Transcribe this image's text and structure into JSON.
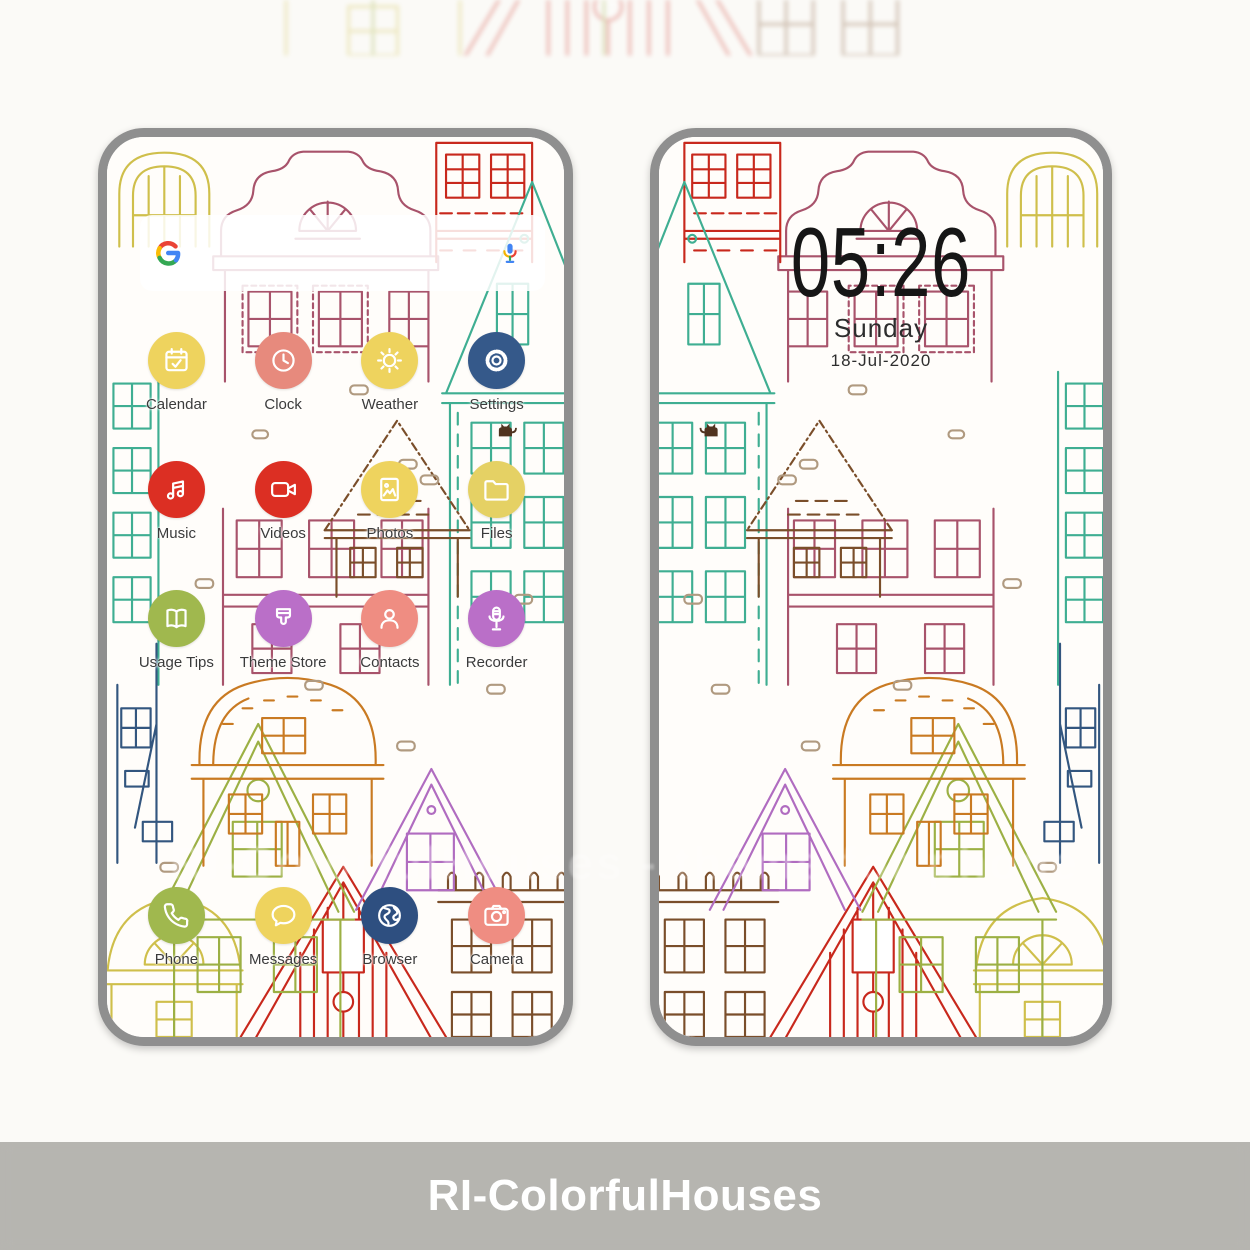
{
  "banner": {
    "title": "RI-ColorfulHouses"
  },
  "watermark": {
    "text": "RI-ColorfulHouses - theme for phone"
  },
  "left_phone": {
    "screen": "home",
    "search_widget": {
      "logo_icon": "google-g-icon",
      "mic_icon": "google-mic-icon"
    },
    "app_rows": [
      [
        {
          "label": "Calendar",
          "icon": "calendar-icon",
          "color": "#eed35e"
        },
        {
          "label": "Clock",
          "icon": "clock-icon",
          "color": "#e78a7d"
        },
        {
          "label": "Weather",
          "icon": "weather-icon",
          "color": "#eed35e"
        },
        {
          "label": "Settings",
          "icon": "settings-icon",
          "color": "#35598a"
        }
      ],
      [
        {
          "label": "Music",
          "icon": "music-icon",
          "color": "#dc2f23"
        },
        {
          "label": "Videos",
          "icon": "videos-icon",
          "color": "#dc2f23"
        },
        {
          "label": "Photos",
          "icon": "photos-icon",
          "color": "#eed35e"
        },
        {
          "label": "Files",
          "icon": "files-icon",
          "color": "#e5d164"
        }
      ],
      [
        {
          "label": "Usage Tips",
          "icon": "usage-tips-icon",
          "color": "#a0b84e"
        },
        {
          "label": "Theme Store",
          "icon": "theme-store-icon",
          "color": "#ba6fc8"
        },
        {
          "label": "Contacts",
          "icon": "contacts-icon",
          "color": "#ef8d82"
        },
        {
          "label": "Recorder",
          "icon": "recorder-icon",
          "color": "#ba6fc8"
        }
      ]
    ],
    "dock": [
      {
        "label": "Phone",
        "icon": "phone-icon",
        "color": "#a0b84e"
      },
      {
        "label": "Messages",
        "icon": "messages-icon",
        "color": "#eed35e"
      },
      {
        "label": "Browser",
        "icon": "browser-icon",
        "color": "#2e4f80"
      },
      {
        "label": "Camera",
        "icon": "camera-icon",
        "color": "#ef8d82"
      }
    ]
  },
  "right_phone": {
    "screen": "lock",
    "time": "05:26",
    "day": "Sunday",
    "date": "18-Jul-2020"
  }
}
